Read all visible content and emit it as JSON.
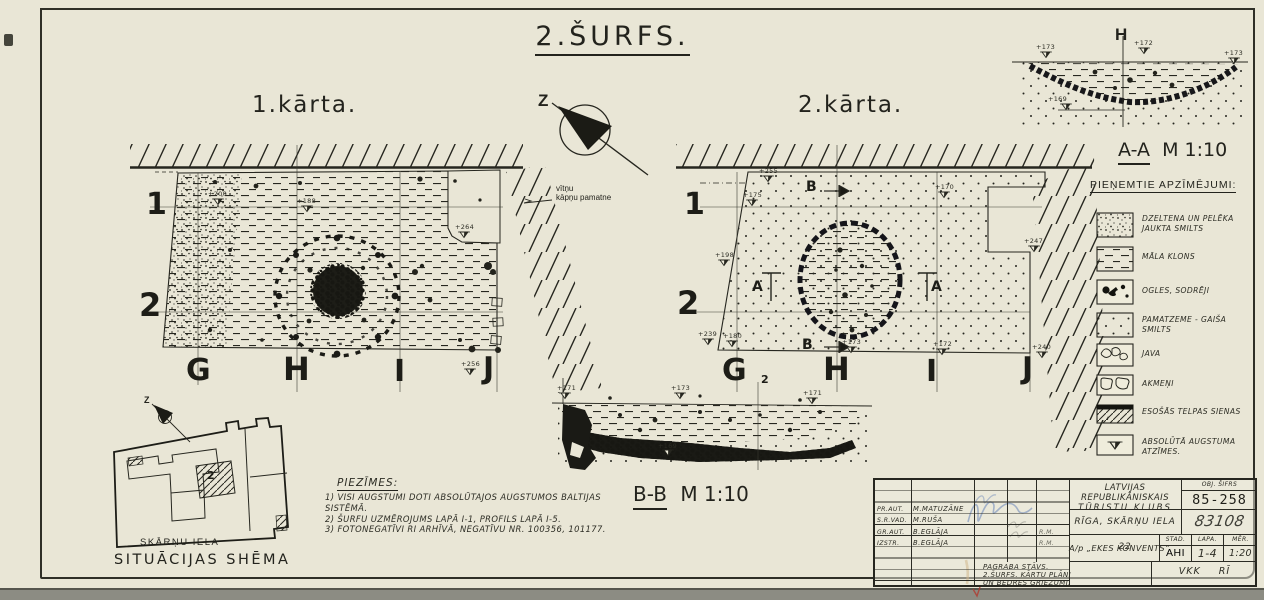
{
  "sheet_title": "2.ŠURFS.",
  "north": {
    "label": "Z"
  },
  "plan1": {
    "label": "1.kārta.",
    "rows": [
      "1",
      "2"
    ],
    "cols": [
      "G",
      "H",
      "I",
      "J"
    ],
    "annotation_line1": "vītņu",
    "annotation_line2": "kāpņu pamatne",
    "elevations": [
      "+200",
      "+188",
      "+264",
      "+256"
    ]
  },
  "plan2": {
    "label": "2.kārta.",
    "rows": [
      "1",
      "2"
    ],
    "cols": [
      "G",
      "H",
      "I",
      "J"
    ],
    "marker_a": "A",
    "marker_b": "B",
    "elevations": [
      "+255",
      "+175",
      "+198",
      "+239",
      "+180",
      "+173",
      "+172",
      "+247",
      "+240",
      "+170"
    ]
  },
  "section_aa": {
    "name": "A-A",
    "scale": "M 1:10",
    "axis_label": "H",
    "elevations": [
      "+173",
      "+172",
      "+173",
      "+169"
    ]
  },
  "section_bb": {
    "name": "B-B",
    "scale": "M 1:10",
    "grid_number": "2",
    "elevations": [
      "+171",
      "+173",
      "+171",
      "+169"
    ]
  },
  "legend": {
    "title": "PIEŅEMTIE APZĪMĒJUMI:",
    "items": [
      {
        "label": "DZELTENA UN PELĒKA JAUKTA SMILTS",
        "pattern": "speckle"
      },
      {
        "label": "MĀLA KLONS",
        "pattern": "dashes"
      },
      {
        "label": "OGLES, SODRĒJI",
        "pattern": "coal-blobs"
      },
      {
        "label": "PAMATZEME - GAIŠA SMILTS",
        "pattern": "dots"
      },
      {
        "label": "JAVA",
        "pattern": "mortar-squiggle"
      },
      {
        "label": "AKMEŅI",
        "pattern": "stones"
      },
      {
        "label": "ESOŠĀS TELPAS SIENAS",
        "pattern": "hatch"
      },
      {
        "label": "ABSOLŪTĀ AUGSTUMA ATZĪMES.",
        "pattern": "elevation-flag"
      }
    ]
  },
  "notes": {
    "title": "PIEZĪMES:",
    "items": [
      "1) VISI AUGSTUMI DOTI ABSOLŪTAJOS AUGSTUMOS BALTIJAS SISTĒMĀ.",
      "2) ŠURFU UZMĒROJUMS LAPĀ I-1, PROFILS LAPĀ I-5.",
      "3) FOTONEGATĪVI RI ARHĪVĀ, NEGATĪVU NR. 100356, 101177."
    ]
  },
  "situation": {
    "title": "SITUĀCIJAS SHĒMA",
    "street": "SKĀRŅU IELA",
    "room_label": "2",
    "north_label": "Z"
  },
  "titleblock": {
    "sign_rows": [
      {
        "role": "PR.AUT.",
        "name": "M.MATUZĀNE"
      },
      {
        "role": "S.R.VAD.",
        "name": "M.RUŠA"
      },
      {
        "role": "GR.AUT.",
        "name": "B.EGLĀJA",
        "initials": "R.M."
      },
      {
        "role": "IZSTR.",
        "name": "B.EGLĀJA",
        "initials": "R.M."
      }
    ],
    "org_line1": "LATVIJAS REPUBLIKĀNISKAIS",
    "org_line2": "TŪRISTU KLUBS",
    "obj_code_label": "OBJ. ŠIFRS",
    "obj_code": "85-258",
    "address": "RĪGA, SKĀRŅU IELA 22",
    "reg_number": "83108",
    "object_name": "A/p „EKES KONVENTS”",
    "stage_label": "STAD.",
    "stage": "AHI",
    "sheet_label": "LAPA.",
    "sheet_number": "1-4",
    "scale_label": "MĒR.",
    "scale": "1:20",
    "description_line1": "PAGRABA STĀVS.",
    "description_line2": "2.ŠURFS. KĀRTU PLĀNI",
    "description_line3": "UN BEDRES GRIEZUMI.",
    "archive_mark": "VKK RĪ"
  },
  "colors": {
    "paper": "#e9e6d6",
    "ink": "#26261f",
    "signature_blue": "#3d62aa",
    "scan_band_grey": "#8c8c83"
  }
}
